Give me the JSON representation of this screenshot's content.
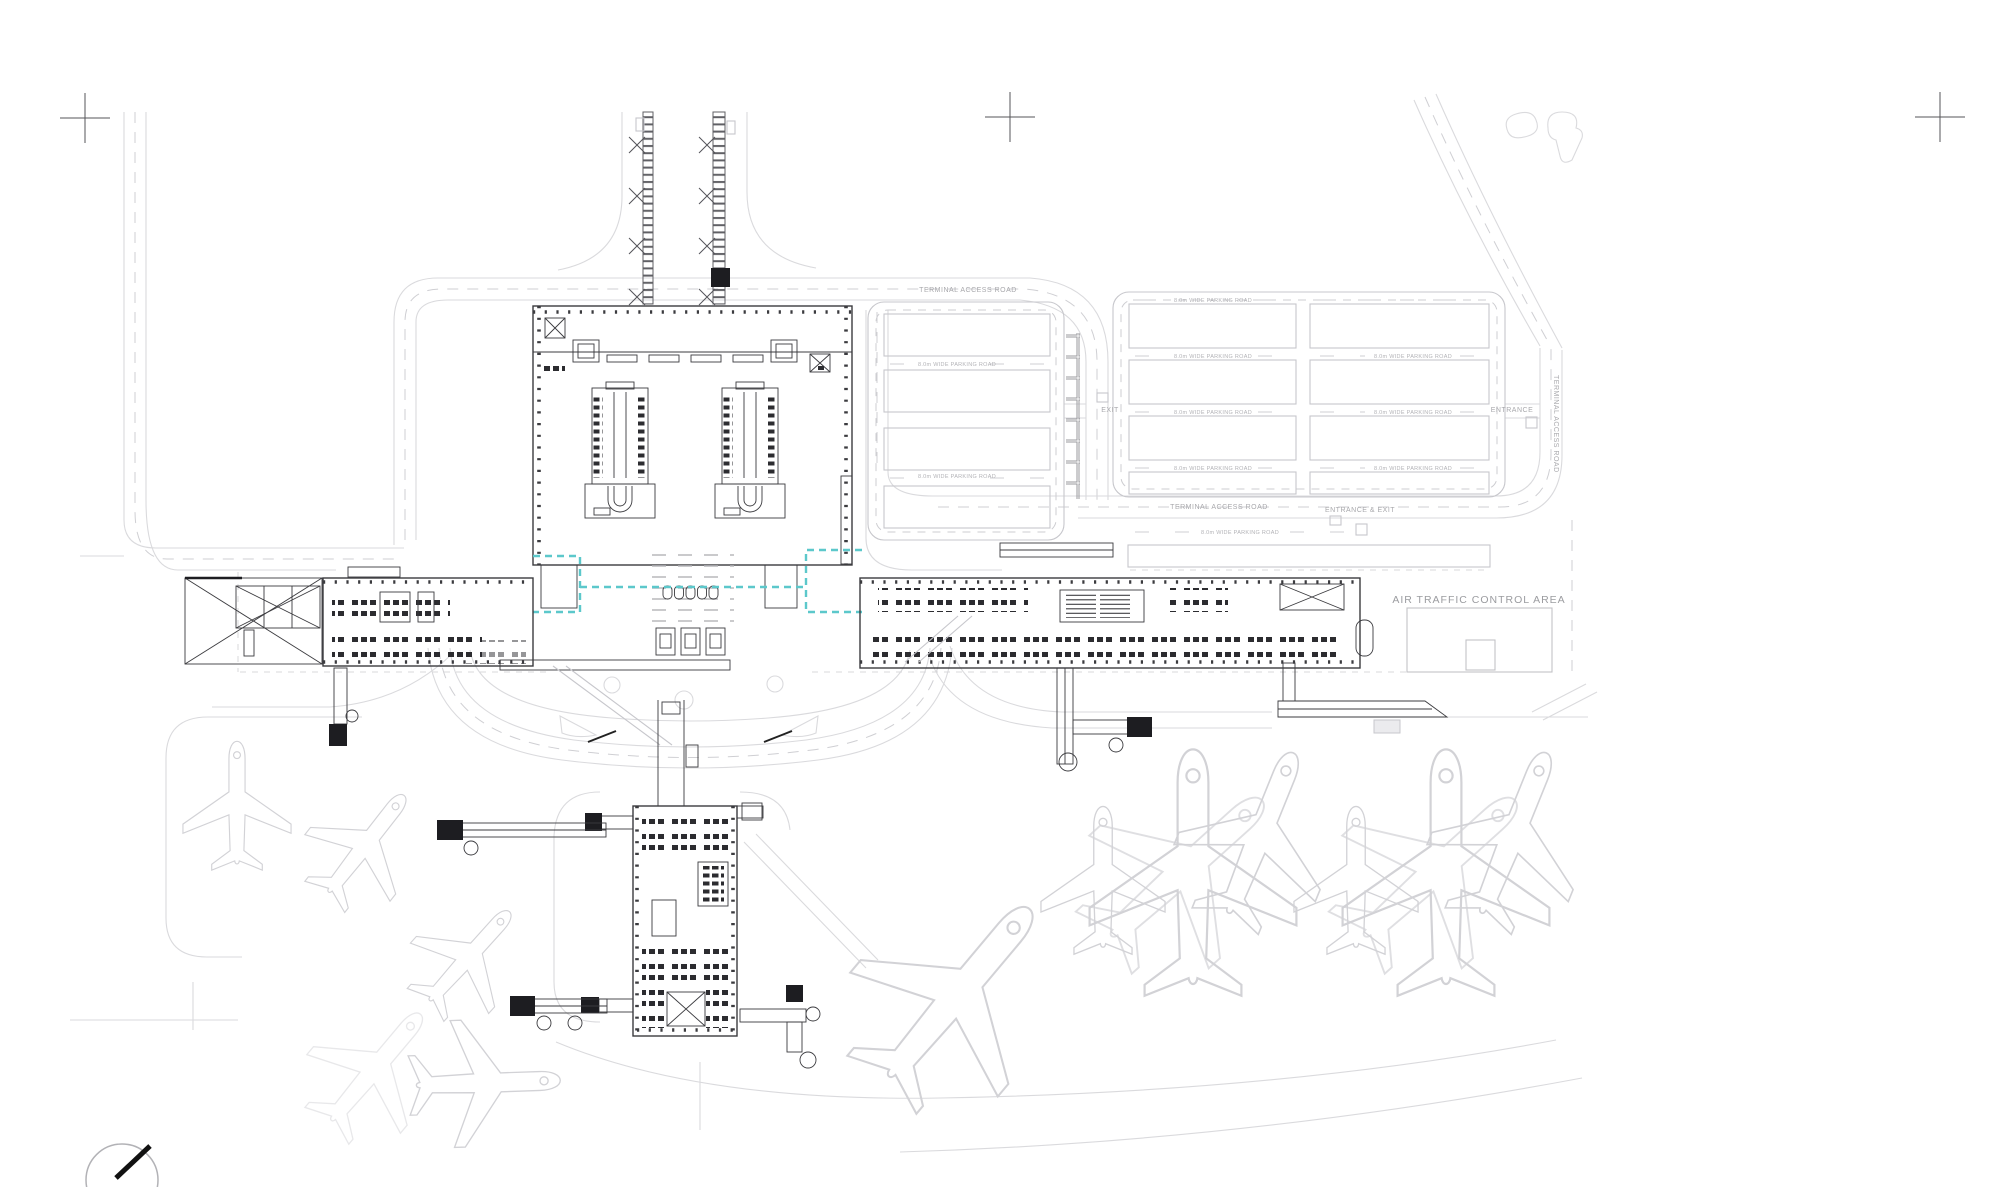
{
  "drawing": {
    "type": "airport-terminal-site-plan",
    "background": "#ffffff",
    "colors": {
      "accent_teal": "#5cc8cb",
      "structure_dark": "#3b3b3f",
      "road_light": "#dadadd",
      "label_gray": "#a8a8ac"
    },
    "labels": {
      "terminal_access_road": "TERMINAL ACCESS ROAD",
      "parking_road": "8.0m WIDE PARKING ROAD",
      "entrance_and_exit": "ENTRANCE & EXIT",
      "entrance": "ENTRANCE",
      "exit": "EXIT",
      "air_traffic_control_area": "AIR TRAFFIC CONTROL AREA"
    }
  }
}
